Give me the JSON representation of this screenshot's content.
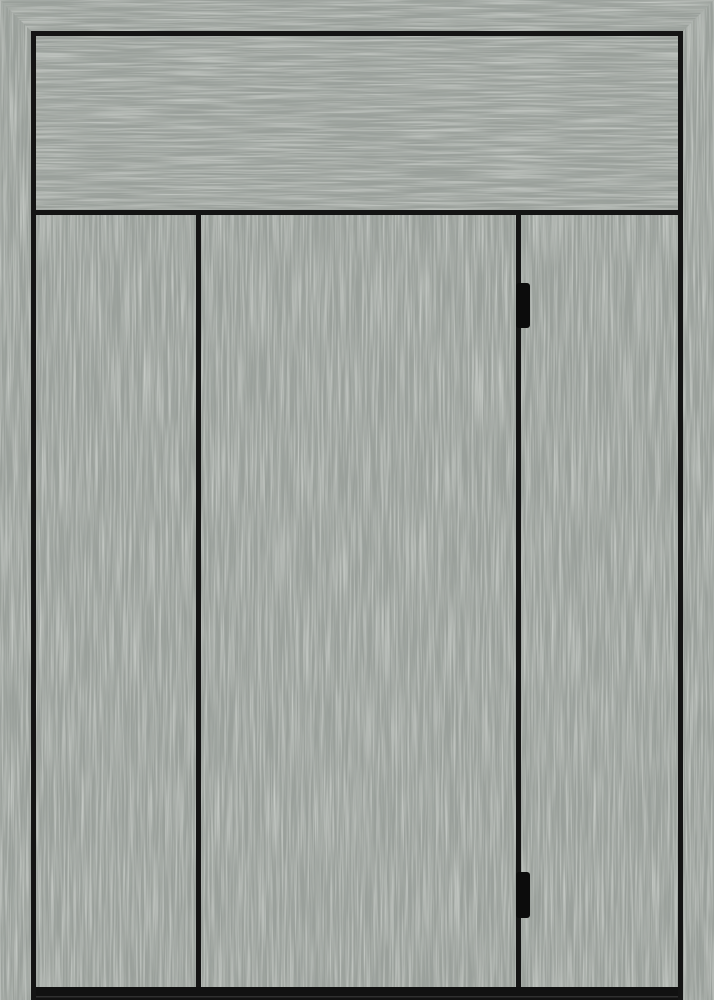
{
  "scene": {
    "title": "Gray brushed-texture door front with transom, three vertical panels and two hinges",
    "type": "door-render"
  },
  "colors": {
    "base_gray": "#9aa09b",
    "streak_light": "#c6cbc4",
    "streak_dark": "#667066",
    "line_black": "#141414",
    "hinge_black": "#0c0c0c",
    "bottom_bar": "#111111",
    "bottom_seam": "#4a4a4a",
    "page_background": "#ffffff"
  },
  "door": {
    "transom_panels": 1,
    "vertical_panels": 3,
    "hinge_count": 2,
    "hinge_location": "right panel divider",
    "frame": "mitered top corners, no bottom rail"
  }
}
